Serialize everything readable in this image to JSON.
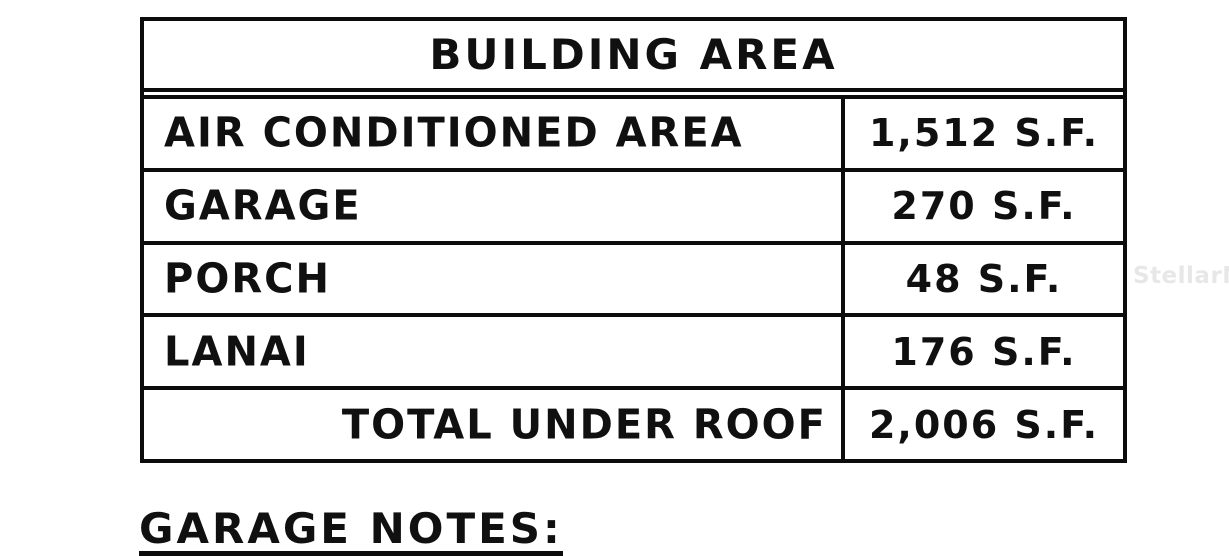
{
  "table": {
    "title": "BUILDING AREA",
    "rows": [
      {
        "label": "AIR CONDITIONED AREA",
        "value": "1,512 S.F."
      },
      {
        "label": "GARAGE",
        "value": "270 S.F."
      },
      {
        "label": "PORCH",
        "value": "48 S.F."
      },
      {
        "label": "LANAI",
        "value": "176 S.F."
      }
    ],
    "total_row": {
      "label": "TOTAL UNDER ROOF",
      "value": "2,006 S.F."
    }
  },
  "notes": {
    "heading": "GARAGE NOTES:"
  },
  "watermark": {
    "text": "StellarMLS"
  },
  "colors": {
    "line": "#0c0c0c",
    "text": "#101010",
    "background": "#ffffff",
    "watermark": "#e7e7e7"
  }
}
